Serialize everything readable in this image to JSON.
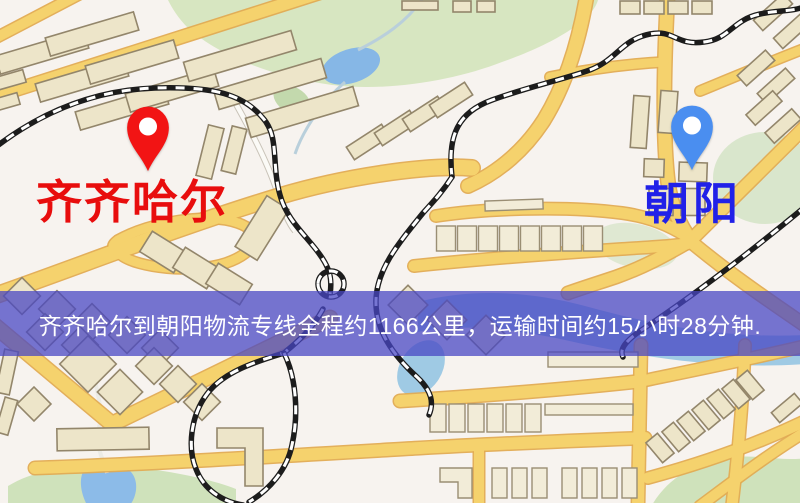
{
  "map": {
    "origin_marker": {
      "label": "齐齐哈尔",
      "pin_color": "#f21414",
      "pin_hole_color": "#ffffff",
      "label_color": "#e80d0d"
    },
    "destination_marker": {
      "label": "朝阳",
      "pin_color": "#4a8ef0",
      "pin_hole_color": "#ffffff",
      "label_color": "#2121e8"
    }
  },
  "banner": {
    "text": "齐齐哈尔到朝阳物流专线全程约1166公里，运输时间约15小时28分钟.",
    "background_color": "#4846c4",
    "text_color": "#ffffff"
  },
  "route": {
    "origin": "齐齐哈尔",
    "destination": "朝阳",
    "distance_text": "约1166公里",
    "duration_text": "约15小时28分钟"
  },
  "map_palette": {
    "land": "#f7f3ef",
    "road": "#f5d26d",
    "road_casing": "#e2ab52",
    "building": "#ede5c9",
    "building_outline": "#93866b",
    "park": "#d7e6c1",
    "water": "#8cbbe8",
    "railway": "#1c1c1c"
  }
}
